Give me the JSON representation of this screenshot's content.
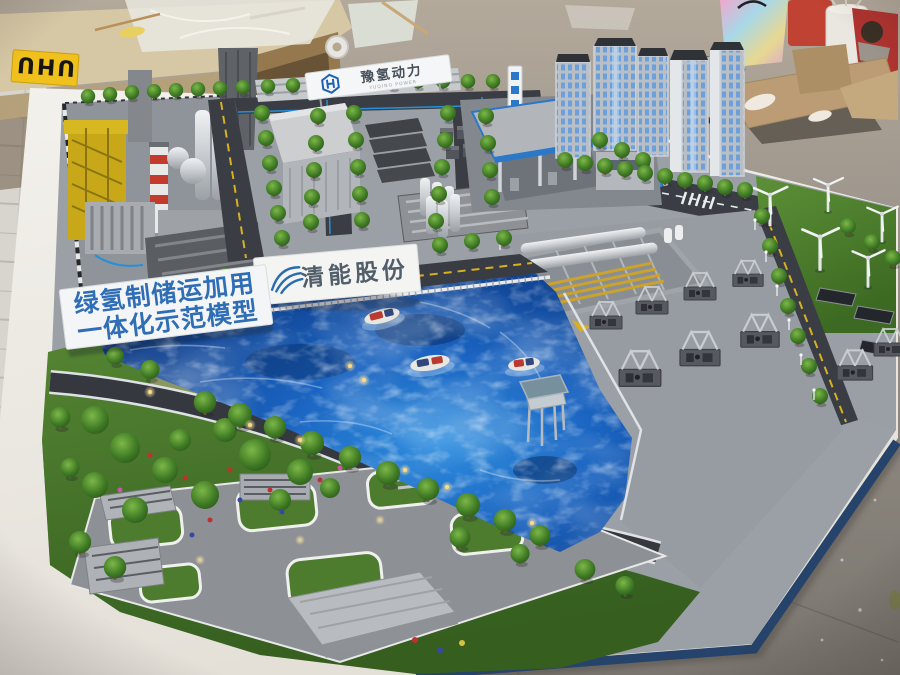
{
  "scene": {
    "type": "photograph",
    "subject": "Architectural scale model of a green-hydrogen industrial park on a white display table inside a model-making workshop"
  },
  "labels": {
    "front_sign_line1": "绿氢制储运加用",
    "front_sign_line2": "一体化示范模型",
    "billboard_text": "清能股份",
    "roof_banner_title": "豫氢动力",
    "roof_banner_subtitle": "YUQING POWER",
    "glue_box_text": "UHU"
  },
  "colors": {
    "water_deep": "#0a2a63",
    "water_bright": "#2f8fe0",
    "grass": "#4a7c2e",
    "road": "#3a3e44",
    "road_line_yellow": "#d8b020",
    "table_top": "#efede8",
    "table_trim_navy": "#26436b",
    "floor": "#8d8780",
    "workbench": "#d2c3a2",
    "sign_text_blue": "#2f6db5",
    "brand_blue": "#2b6cb0",
    "smokestack_red": "#c23b2d",
    "crane_yellow": "#c8a818",
    "tube_trailer_yellow": "#caa22c",
    "tower_window_blue": "#6d9fd8",
    "glue_box_yellow": "#f0c01c"
  },
  "model_zones": [
    "industrial-hydrogen-plant",
    "electrolyzer-warehouse",
    "hydrogen-refueling-station",
    "high-rise-buildings",
    "wind-turbine-field",
    "solar-panels",
    "hydrogen-storage-yard",
    "compressor-skids",
    "water-channel",
    "tour-boats",
    "observation-platform",
    "landscaped-park",
    "parking-plaza"
  ]
}
